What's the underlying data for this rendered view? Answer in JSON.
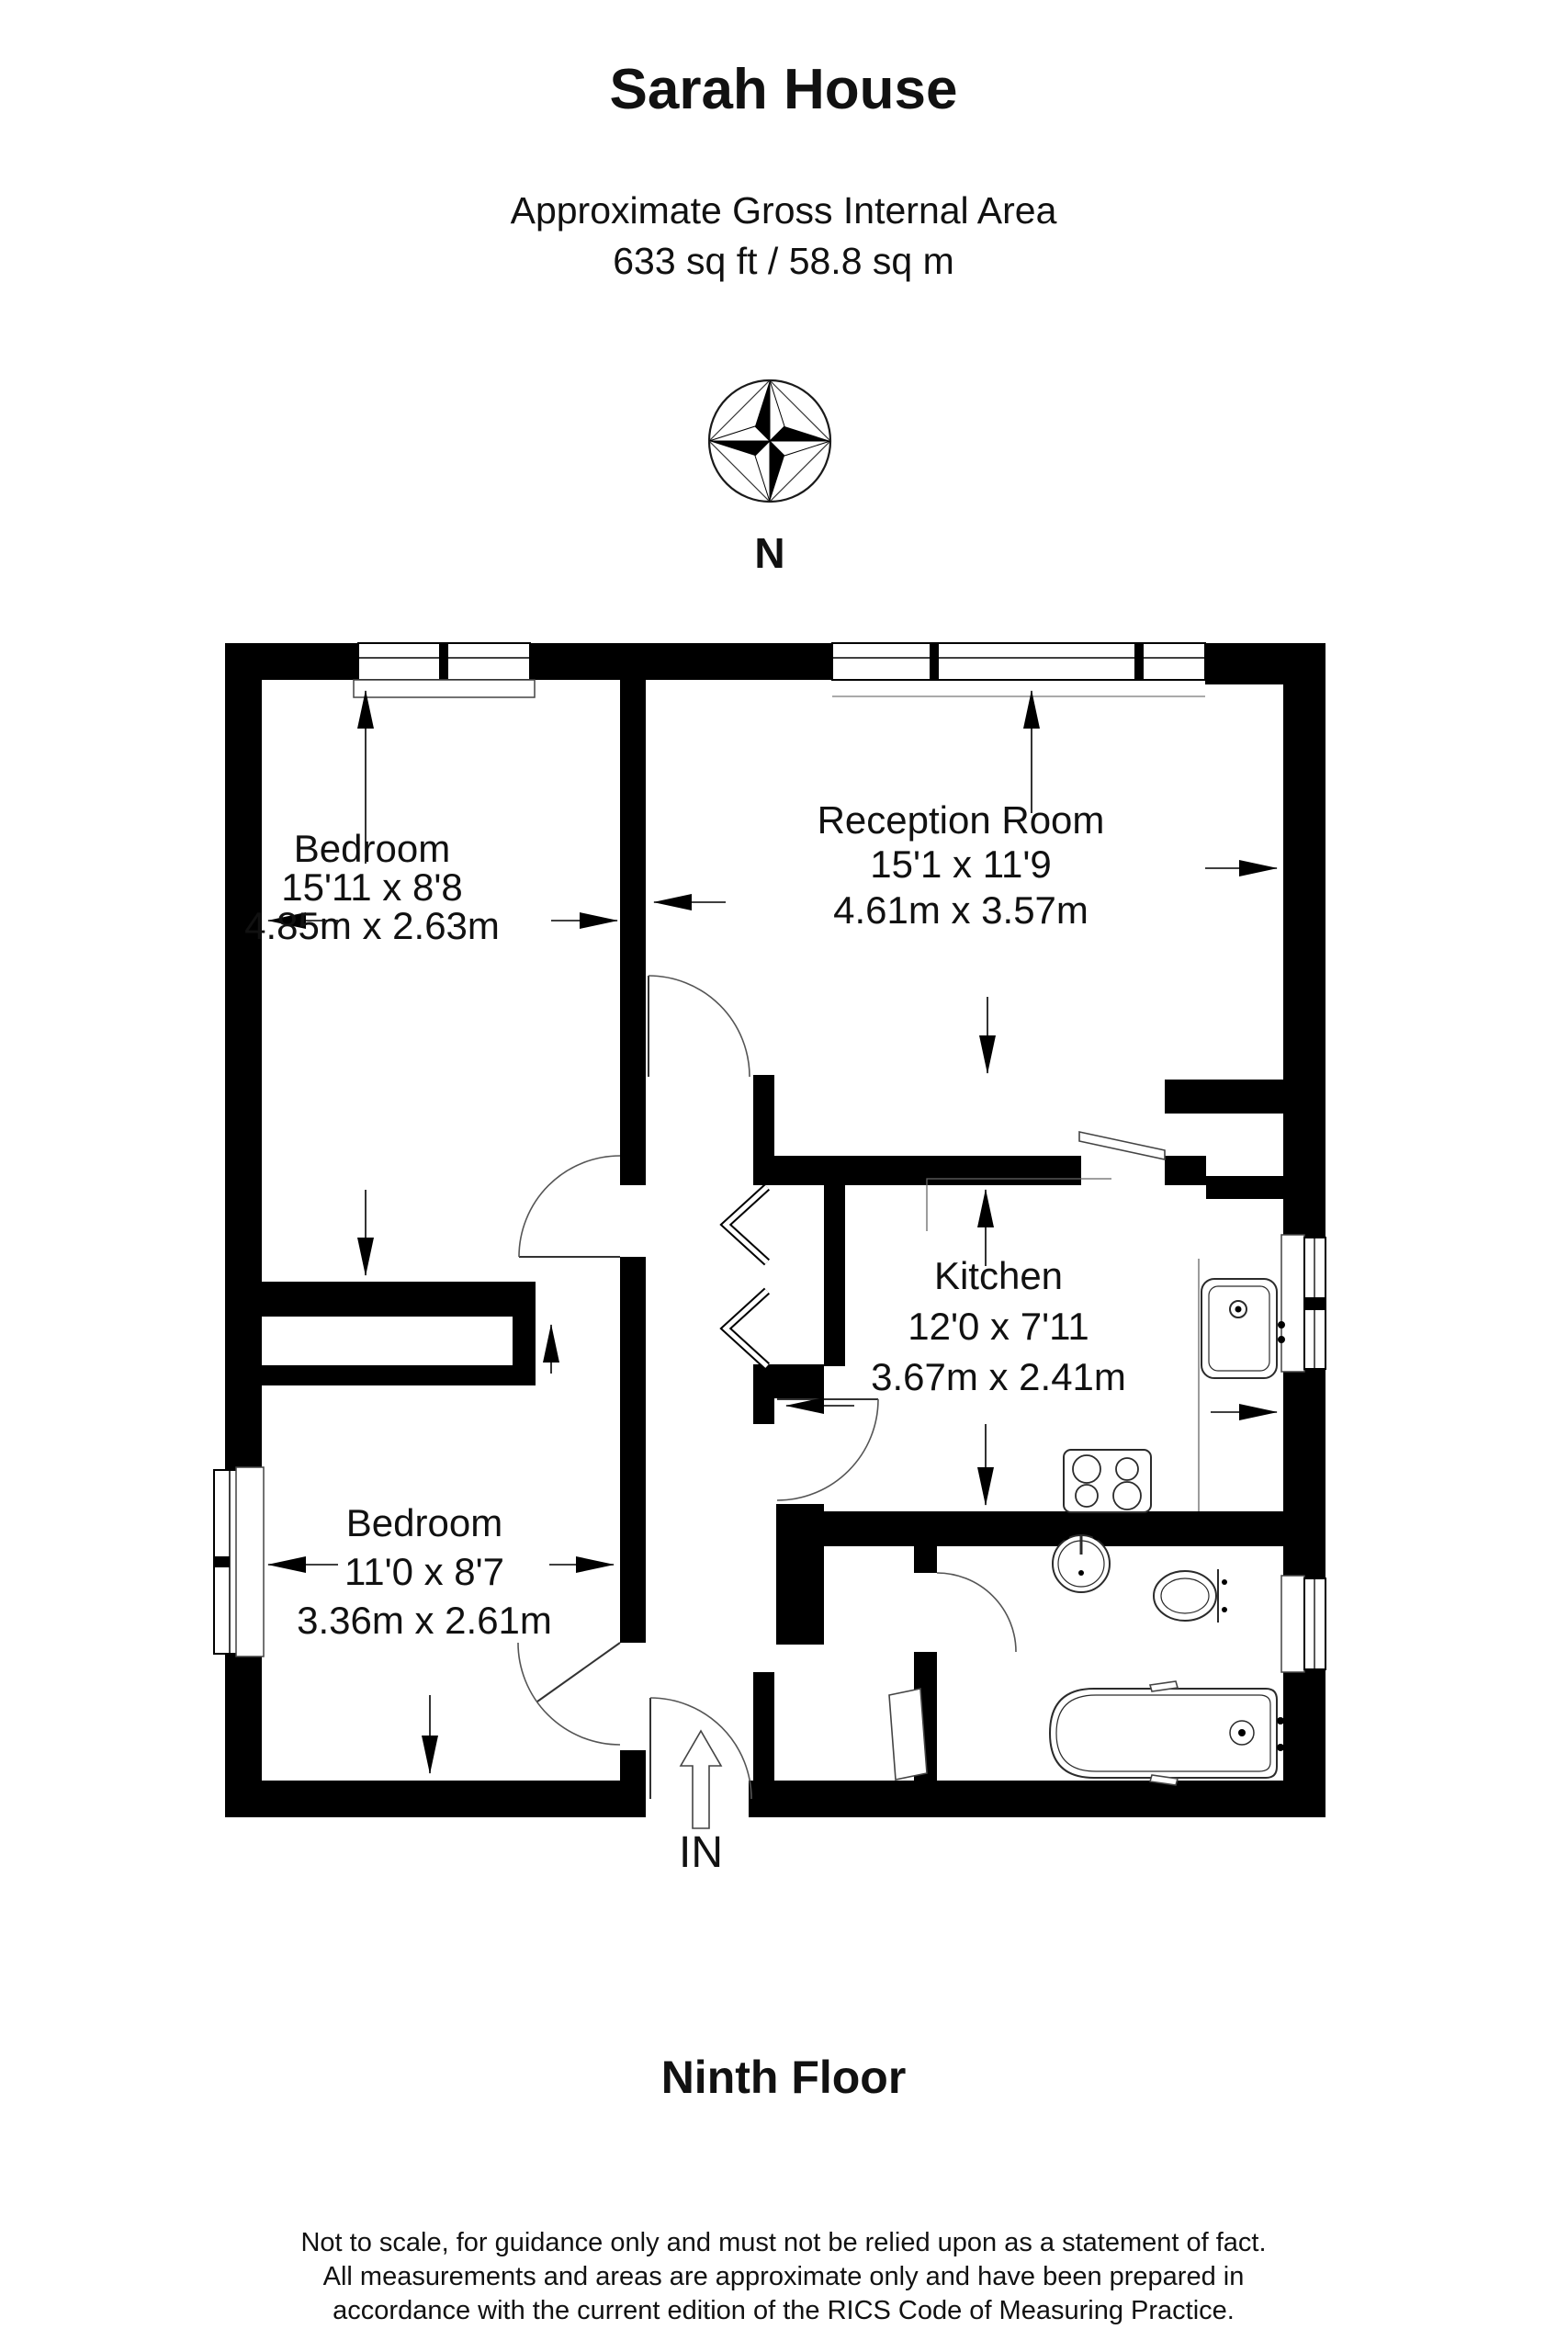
{
  "header": {
    "title": "Sarah House",
    "area_label": "Approximate Gross Internal Area",
    "area_value": "633 sq ft / 58.8 sq m"
  },
  "compass": {
    "label": "N"
  },
  "rooms": [
    {
      "id": "bedroom-1",
      "name": "Bedroom",
      "size_imperial": "15'11 x 8'8",
      "size_metric": "4.85m x 2.63m"
    },
    {
      "id": "reception-room",
      "name": "Reception Room",
      "size_imperial": "15'1 x 11'9",
      "size_metric": "4.61m x 3.57m"
    },
    {
      "id": "kitchen",
      "name": "Kitchen",
      "size_imperial": "12'0 x 7'11",
      "size_metric": "3.67m x 2.41m"
    },
    {
      "id": "bedroom-2",
      "name": "Bedroom",
      "size_imperial": "11'0 x 8'7",
      "size_metric": "3.36m x 2.61m"
    }
  ],
  "entrance": {
    "label": "IN"
  },
  "floor": {
    "label": "Ninth Floor"
  },
  "disclaimer": {
    "line1": "Not to scale, for guidance only and must not be relied upon as a statement of fact.",
    "line2": "All measurements and areas are approximate only and have been prepared in",
    "line3": "accordance with the current edition of the RICS Code of Measuring Practice."
  },
  "colors": {
    "wall": "#000000",
    "background": "#ffffff"
  }
}
